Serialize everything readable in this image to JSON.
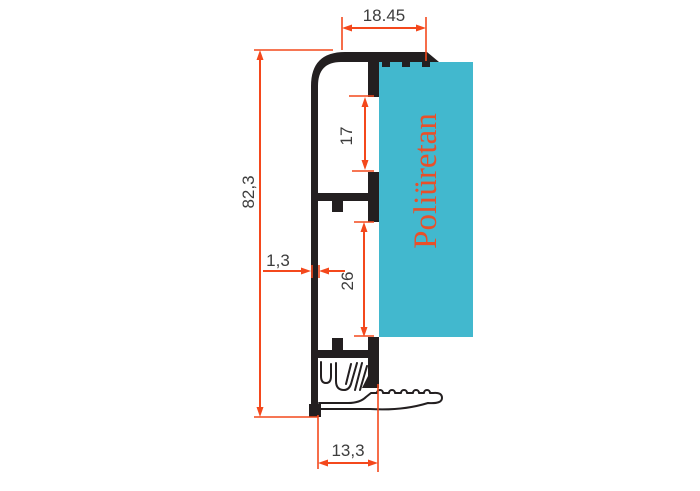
{
  "drawing": {
    "title": "aluminium-profile-cross-section",
    "material_label": "Poliüretan",
    "dims": {
      "top_width": "18.45",
      "upper_pocket_height": "17",
      "lower_pocket_height": "26",
      "overall_height": "82,3",
      "wall_thickness": "1,3",
      "bottom_width": "13,3"
    },
    "colors": {
      "foam": "#42b8ce",
      "dimension": "#f4481c",
      "label": "#e8502a",
      "profile": "#231f20",
      "dim_text": "#3d3d3d",
      "background": "#ffffff"
    }
  }
}
